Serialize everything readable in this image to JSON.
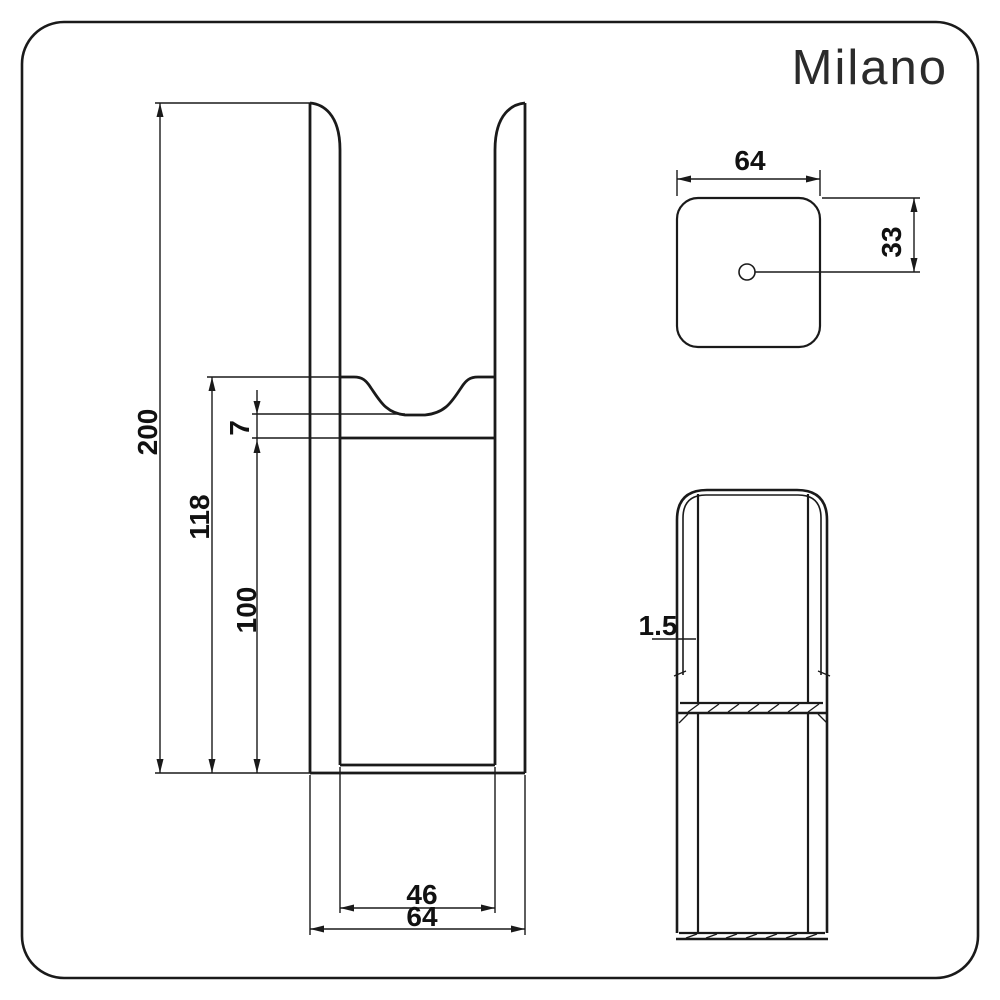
{
  "brand": "Milano",
  "drawing": {
    "front_view": {
      "total_height": "200",
      "upper_section_height": "118",
      "lower_section_height": "100",
      "saddle_depth": "7",
      "inner_width": "46",
      "outer_width": "64"
    },
    "top_view": {
      "width": "64",
      "edge_to_centre": "33"
    },
    "side_view": {
      "wall_thickness": "1.5"
    }
  },
  "colors": {
    "line": "#1a1a1a",
    "background": "#ffffff"
  }
}
